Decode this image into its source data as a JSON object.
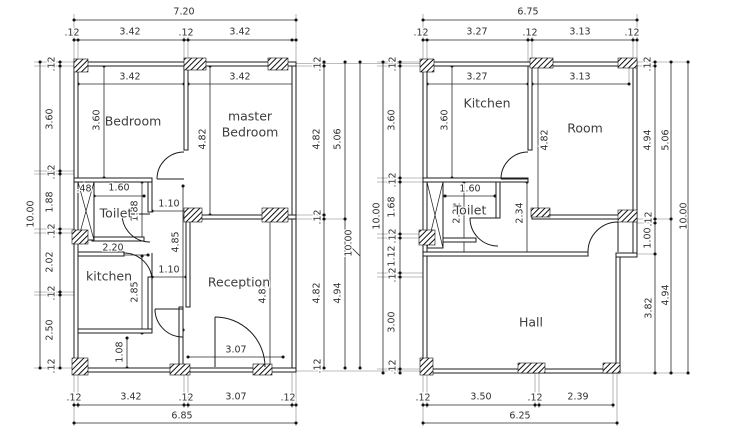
{
  "document": {
    "kind": "architectural floor plan drawing",
    "background_color": "#ffffff",
    "line_color": "#1b1b1b",
    "text_color": "#3d3d3d"
  },
  "plans": [
    {
      "id": "plan-a",
      "overall_width": "7.20",
      "overall_height": "10.00",
      "bottom_width": "6.85",
      "room_labels": [
        {
          "text": "Bedroom",
          "x": 133,
          "y": 121
        },
        {
          "text": "master",
          "x": 250,
          "y": 116
        },
        {
          "text": "Bedroom",
          "x": 250,
          "y": 132
        },
        {
          "text": "Toilet",
          "x": 116,
          "y": 213
        },
        {
          "text": "kitchen",
          "x": 109,
          "y": 276
        },
        {
          "text": "Reception",
          "x": 239,
          "y": 282
        }
      ],
      "dim_labels": [
        {
          "text": "7.20",
          "x": 184,
          "y": 12
        },
        {
          "text": ".12",
          "x": 72,
          "y": 33
        },
        {
          "text": "3.42",
          "x": 130,
          "y": 32
        },
        {
          "text": ".12",
          "x": 186,
          "y": 33
        },
        {
          "text": "3.42",
          "x": 240,
          "y": 32
        },
        {
          "text": "3.42",
          "x": 130,
          "y": 77
        },
        {
          "text": "3.42",
          "x": 240,
          "y": 77
        },
        {
          "text": ".48",
          "x": 84,
          "y": 189
        },
        {
          "text": "1.60",
          "x": 119,
          "y": 188
        },
        {
          "text": "1.10",
          "x": 169,
          "y": 204
        },
        {
          "text": "2.20",
          "x": 113,
          "y": 248
        },
        {
          "text": "1.10",
          "x": 169,
          "y": 270
        },
        {
          "text": "3.07",
          "x": 236,
          "y": 350
        },
        {
          "text": ".12",
          "x": 74,
          "y": 398
        },
        {
          "text": "3.42",
          "x": 131,
          "y": 397
        },
        {
          "text": ".12",
          "x": 186,
          "y": 398
        },
        {
          "text": "3.07",
          "x": 236,
          "y": 397
        },
        {
          "text": ".12",
          "x": 288,
          "y": 398
        },
        {
          "text": "6.85",
          "x": 182,
          "y": 416
        },
        {
          "text": ".12",
          "x": 52,
          "y": 64,
          "rot": -90
        },
        {
          "text": "3.60",
          "x": 50,
          "y": 119,
          "rot": -90
        },
        {
          "text": ".12",
          "x": 52,
          "y": 172,
          "rot": -90
        },
        {
          "text": "1.88",
          "x": 50,
          "y": 202,
          "rot": -90
        },
        {
          "text": ".12",
          "x": 52,
          "y": 231,
          "rot": -90
        },
        {
          "text": "2.02",
          "x": 50,
          "y": 262,
          "rot": -90
        },
        {
          "text": ".12",
          "x": 52,
          "y": 293,
          "rot": -90
        },
        {
          "text": "2.50",
          "x": 50,
          "y": 330,
          "rot": -90
        },
        {
          "text": ".12",
          "x": 52,
          "y": 366,
          "rot": -90
        },
        {
          "text": "10.00",
          "x": 31,
          "y": 214,
          "rot": -90
        },
        {
          "text": "3.60",
          "x": 97,
          "y": 120,
          "rot": -90
        },
        {
          "text": "4.82",
          "x": 203,
          "y": 139,
          "rot": -90
        },
        {
          "text": "1.88",
          "x": 135,
          "y": 211,
          "rot": -90
        },
        {
          "text": "4.85",
          "x": 176,
          "y": 242,
          "rot": -90
        },
        {
          "text": "2.85",
          "x": 135,
          "y": 292,
          "rot": -90
        },
        {
          "text": "1.08",
          "x": 120,
          "y": 352,
          "rot": -90
        },
        {
          "text": "4.82",
          "x": 263,
          "y": 293,
          "rot": -90
        },
        {
          "text": ".12",
          "x": 318,
          "y": 64,
          "rot": -90
        },
        {
          "text": "4.82",
          "x": 317,
          "y": 139,
          "rot": -90
        },
        {
          "text": ".12",
          "x": 318,
          "y": 217,
          "rot": -90
        },
        {
          "text": "4.82",
          "x": 317,
          "y": 293,
          "rot": -90
        },
        {
          "text": ".12",
          "x": 318,
          "y": 366,
          "rot": -90
        },
        {
          "text": "5.06",
          "x": 338,
          "y": 139,
          "rot": -90
        },
        {
          "text": "4.94",
          "x": 338,
          "y": 293,
          "rot": -90
        },
        {
          "text": "10.00",
          "x": 349,
          "y": 243,
          "rot": -90
        }
      ]
    },
    {
      "id": "plan-b",
      "overall_width": "6.75",
      "overall_height": "10.00",
      "bottom_width": "6.25",
      "room_labels": [
        {
          "text": "Kitchen",
          "x": 487,
          "y": 103
        },
        {
          "text": "Room",
          "x": 585,
          "y": 128
        },
        {
          "text": "Toilet",
          "x": 470,
          "y": 210
        },
        {
          "text": "Hall",
          "x": 531,
          "y": 322
        }
      ],
      "dim_labels": [
        {
          "text": "6.75",
          "x": 528,
          "y": 12
        },
        {
          "text": ".12",
          "x": 421,
          "y": 33
        },
        {
          "text": "3.27",
          "x": 477,
          "y": 32
        },
        {
          "text": ".12",
          "x": 530,
          "y": 33
        },
        {
          "text": "3.13",
          "x": 580,
          "y": 32
        },
        {
          "text": ".12",
          "x": 632,
          "y": 33
        },
        {
          "text": "3.27",
          "x": 477,
          "y": 77
        },
        {
          "text": "3.13",
          "x": 580,
          "y": 77
        },
        {
          "text": "1.60",
          "x": 470,
          "y": 189
        },
        {
          "text": ".12",
          "x": 423,
          "y": 398
        },
        {
          "text": "3.50",
          "x": 481,
          "y": 397
        },
        {
          "text": ".12",
          "x": 535,
          "y": 398
        },
        {
          "text": "2.39",
          "x": 578,
          "y": 397
        },
        {
          "text": "6.25",
          "x": 520,
          "y": 416
        },
        {
          "text": ".12",
          "x": 393,
          "y": 64,
          "rot": -90
        },
        {
          "text": "3.60",
          "x": 392,
          "y": 120,
          "rot": -90
        },
        {
          "text": ".12",
          "x": 393,
          "y": 180,
          "rot": -90
        },
        {
          "text": "1.68",
          "x": 392,
          "y": 207,
          "rot": -90
        },
        {
          "text": ".12",
          "x": 393,
          "y": 236,
          "rot": -90
        },
        {
          "text": "1.12",
          "x": 392,
          "y": 256,
          "rot": -90
        },
        {
          "text": ".12",
          "x": 393,
          "y": 275,
          "rot": -90
        },
        {
          "text": "3.00",
          "x": 392,
          "y": 322,
          "rot": -90
        },
        {
          "text": ".12",
          "x": 393,
          "y": 367,
          "rot": -90
        },
        {
          "text": "10.00",
          "x": 377,
          "y": 216,
          "rot": -90
        },
        {
          "text": "3.60",
          "x": 445,
          "y": 120,
          "rot": -90
        },
        {
          "text": "2.22",
          "x": 457,
          "y": 213,
          "rot": -90
        },
        {
          "text": "2.34",
          "x": 520,
          "y": 213,
          "rot": -90
        },
        {
          "text": "4.82",
          "x": 545,
          "y": 140,
          "rot": -90
        },
        {
          "text": ".12",
          "x": 648,
          "y": 64,
          "rot": -90
        },
        {
          "text": "4.94",
          "x": 648,
          "y": 140,
          "rot": -90
        },
        {
          "text": ".12",
          "x": 649,
          "y": 219,
          "rot": -90
        },
        {
          "text": "1.00",
          "x": 648,
          "y": 238,
          "rot": -90
        },
        {
          "text": "3.82",
          "x": 649,
          "y": 308,
          "rot": -90
        },
        {
          "text": "5.06",
          "x": 666,
          "y": 140,
          "rot": -90
        },
        {
          "text": "4.94",
          "x": 666,
          "y": 295,
          "rot": -90
        },
        {
          "text": "10.00",
          "x": 684,
          "y": 216,
          "rot": -90
        }
      ]
    }
  ]
}
